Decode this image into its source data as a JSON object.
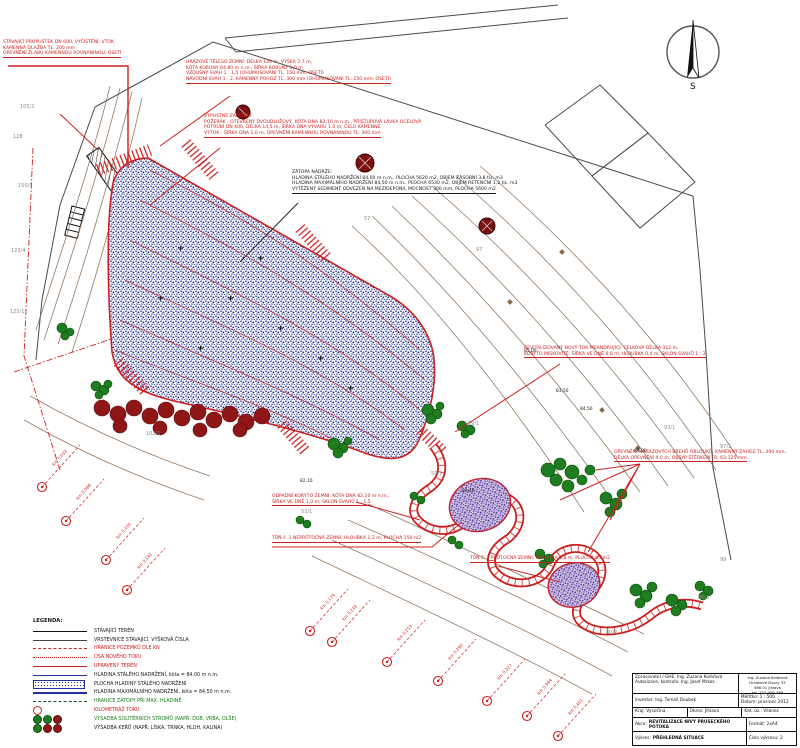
{
  "north_label": "S",
  "notes": {
    "culvert": {
      "lines": [
        "STÁVAJÍCÍ PROPUSTEK DN 600, VYČIŠTĚNÍ, VTOK",
        "KAMENNÁ DLAŽBA TL. 200 mm",
        "OPEVNĚNÍ ŽLABU KAMENNOU ROVNANINOU, OSETÍ"
      ]
    },
    "dam": {
      "lines": [
        "HRÁZOVÉ TĚLESO ZEMNÍ: DÉLKA 120 m, VÝŠKA 2,7 m,",
        "KÓTA KORUNY 84,80 m n.m., ŠÍŘKA KORUNY 3,0 m",
        "VZDUŠNÝ SVAH 1 : 1,5 (OHUMUSOVÁNÍ TL. 150 mm, OSETÍ)",
        "NÁVODNÍ SVAH 1 : 2, KAMENNÝ POHOZ TL. 300 mm (OHUMUSOVÁNÍ TL. 150 mm, OSETÍ)"
      ]
    },
    "outlet": {
      "lines": [
        "VÝPUSTNÉ ZAŘÍZENÍ:",
        "POŽERÁK - OTEVŘENÝ DVOUDLUŽOVÝ, KÓTA DNA 82,10 m n.m., PŘÍSTUPOVÁ LÁVKA OCELOVÁ",
        "POTRUBÍ DN 400, DÉLKA 14,5 m, ŠÍŘKA DNA VÝVARU 1,0 m, ČELO KAMENNÉ",
        "VÝTOK - ŠÍŘKA DNA 1,0 m, OPEVNĚNÍ KAMENNOU ROVNANINOU TL. 300 mm"
      ]
    },
    "flood": {
      "title": "ZÁTOPA NÁDRŽE:",
      "lines": [
        "HLADINA STÁLÉHO NADRŽENÍ 84,00 m n.m., PLOCHA 5620 m2, OBJEM ZÁSOBNÍ 3,8 tis. m3",
        "HLADINA MAXIMÁLNÍHO NADRŽENÍ 84,50 m n.m., PLOCHA 6530 m2, OBJEM RETENČNÍ 1,2 tis. m3",
        "VYTĚŽENÝ SEDIMENT ODVEZEN NA MEZIDEPONII, MOCNOST 300 mm, PLOCHA 5600 m2"
      ]
    },
    "new_channel": {
      "lines": [
        "REVITALIZOVANÝ NOVÝ TOK MEANDRUJÍCÍ, CELKOVÁ DÉLKA 312 m,",
        "KORYTO MISKOVITÉ, ŠÍŘKA VE DNĚ 0,6 m, HLOUBKA 0,4 m, SKLON SVAHŮ 1 : 2"
      ]
    },
    "bank": {
      "lines": [
        "OPEVNĚNÍ NÁRAZOVÝCH BŘEHŮ OBLOUKŮ, KAMENNÝ ZÁHOZ TL. 300 mm,",
        "DÉLKA OPEVNĚNÍ 4,0 m, OBSYP ŠTĚRKEM FR. 63-125 mm"
      ]
    },
    "bypass": {
      "lines": [
        "ODPADNÍ KORYTO ZEMNÍ, KÓTA DNA 82,10 m n.m.,",
        "ŠÍŘKA VE DNĚ 1,0 m, SKLON SVAHŮ 1 : 1,5"
      ]
    },
    "pool1": {
      "lines": [
        "TŮŇ č. 1 NEPRŮTOČNÁ ZEMNÍ, HLOUBKA 1,2 m, PLOCHA 150 m2"
      ]
    },
    "pool2": {
      "lines": [
        "TŮŇ č. 2 PRŮTOČNÁ ZEMNÍ, HLOUBKA 0,8 m, PLOCHA 95 m2"
      ]
    }
  },
  "stations": [
    "km 0,032",
    "km 0,068",
    "km 0,105",
    "km 0,142",
    "km 0,179",
    "km 0,216",
    "km 0,253",
    "km 0,290",
    "km 0,327",
    "km 0,364",
    "km 0,401"
  ],
  "parcels": [
    "105/2",
    "128",
    "150/1",
    "123/4",
    "125/1",
    "57",
    "97",
    "69/1",
    "59/2",
    "93/1",
    "97/1",
    "53/1",
    "80/2",
    "85/3",
    "102/1",
    "99"
  ],
  "elevations": [
    "84,50",
    "84,00",
    "85,00",
    "82,40",
    "82,10",
    "83,50"
  ],
  "legend": {
    "title": "LEGENDA:",
    "items": [
      {
        "label": "STÁVAJÍCÍ TERÉN"
      },
      {
        "label": "VRSTEVNICE STÁVAJÍCÍ, VÝŠKOVÁ ČÍSLA"
      },
      {
        "label": "HRANICE POZEMKŮ DLE KN"
      },
      {
        "label": "OSA NOVÉHO TOKU"
      },
      {
        "label": "UPRAVENÝ TERÉN"
      },
      {
        "label": "HLADINA STÁLÉHO NADRŽENÍ, kóta = 84,00 m n.m."
      },
      {
        "label": "PLOCHA HLADINY STÁLÉHO NADRŽENÍ"
      },
      {
        "label": "HLADINA MAXIMÁLNÍHO NADRŽENÍ, kóta = 84,50 m n.m."
      },
      {
        "label": "HRANICE ZÁTOPY PŘI MAX. HLADINĚ"
      },
      {
        "label": "KILOMETRÁŽ TOKU"
      },
      {
        "label": "VÝSADBA SOLITÉRNÍCH STROMŮ (NAPŘ. DUB, VRBA, OLŠE)"
      },
      {
        "label": "VÝSADBA KEŘŮ (NAPŘ. LÍSKA, TRNKA, HLOH, KALINA)"
      }
    ]
  },
  "titleblock": {
    "zpracovatel": "Zpracovatel / GHE: Ing. Zuzana Kolářová",
    "autorizace": "Autorizace, kontrola: Ing. Josef Mrkos",
    "addr1": "Ing. Zuzana Kolářová",
    "addr2": "Hruškové Dvory 33",
    "addr3": "586 01 Jihlava",
    "addr4": "tel. 731 456 789",
    "investor": "Investor: Ing. Tomáš Doubek",
    "meritko": "Měřítko: 1 : 500",
    "datum": "Datum: prosinec 2012",
    "kraj": "Kraj: Vysočina",
    "okres": "Okres: Jihlava",
    "katuz": "Kat. úz.: Vílanec",
    "akce_label": "Akce:",
    "akce": "REVITALIZACE NIVY PRUSECKÉHO POTOKA",
    "format": "Formát: 2xA4",
    "vykres_label": "Výkres:",
    "vykres": "PŘEHLEDNÁ SITUACE",
    "cislo": "Číslo výkresu: 2"
  }
}
